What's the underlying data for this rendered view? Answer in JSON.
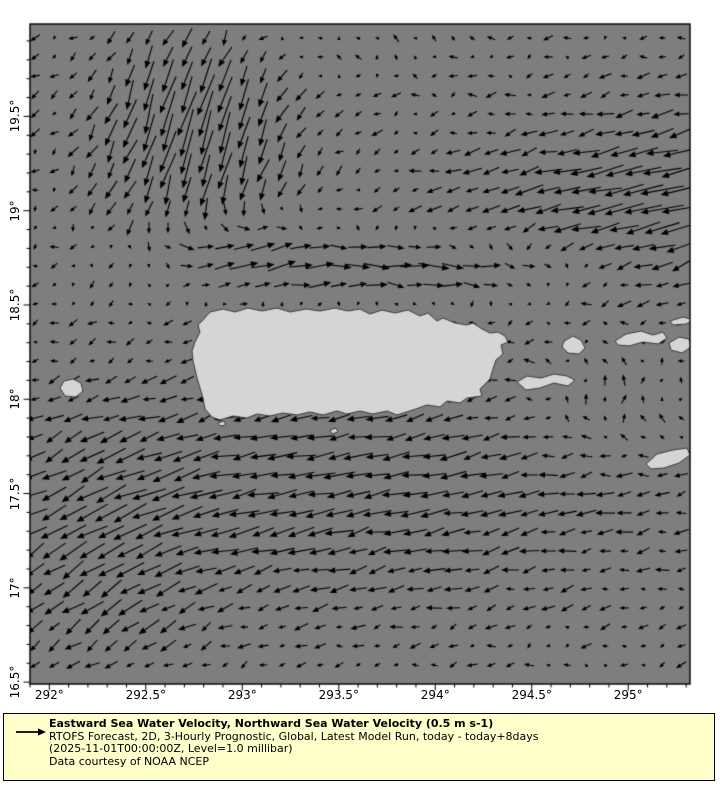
{
  "figure": {
    "width": 720,
    "height": 800,
    "background": "#ffffff"
  },
  "map": {
    "ocean_color": "#7e7e7e",
    "land_fill": "#d5d5d5",
    "land_edge": "#3d3d3d",
    "arrow_color": "#000000",
    "frame_color": "#000000",
    "lon_min": 291.9,
    "lon_max": 295.32,
    "lat_min": 16.49,
    "lat_max": 19.99,
    "x_major_ticks": [
      {
        "lon": 292.0,
        "label": "292°"
      },
      {
        "lon": 292.5,
        "label": "292.5°"
      },
      {
        "lon": 293.0,
        "label": "293°"
      },
      {
        "lon": 293.5,
        "label": "293.5°"
      },
      {
        "lon": 294.0,
        "label": "294°"
      },
      {
        "lon": 294.5,
        "label": "294.5°"
      },
      {
        "lon": 295.0,
        "label": "295°"
      }
    ],
    "y_major_ticks": [
      {
        "lat": 19.5,
        "label": "19.5°"
      },
      {
        "lat": 19.0,
        "label": "19°"
      },
      {
        "lat": 18.5,
        "label": "18.5°"
      },
      {
        "lat": 18.0,
        "label": "18°"
      },
      {
        "lat": 17.5,
        "label": "17.5°"
      },
      {
        "lat": 17.0,
        "label": "17°"
      },
      {
        "lat": 16.5,
        "label": "16.5°"
      }
    ],
    "minor_tick_step_deg": 0.1,
    "grid_step_px": 19,
    "reference_speed_ms": 0.5,
    "reference_arrow_px": 19,
    "jitter": 0.24
  },
  "chart_data": {
    "type": "quiver-vector-map",
    "title": "Eastward Sea Water Velocity, Northward Sea Water Velocity (0.5 m s-1)",
    "x_axis": {
      "label": "longitude",
      "range": [
        291.9,
        295.32
      ],
      "ticks": [
        "292°",
        "292.5°",
        "293°",
        "293.5°",
        "294°",
        "294.5°",
        "295°"
      ]
    },
    "y_axis": {
      "label": "latitude",
      "range": [
        16.49,
        19.99
      ],
      "ticks": [
        "16.5°",
        "17°",
        "17.5°",
        "18°",
        "18.5°",
        "19°",
        "19.5°"
      ]
    },
    "reference_vector": "0.5 m s-1",
    "region": "Puerto Rico and Virgin Islands"
  },
  "flow_features": [
    {
      "name": "nw-southward-jet",
      "type": "gaussian",
      "u": -0.25,
      "v": -1.15,
      "lon0": 292.75,
      "sx": 0.5,
      "lat0": 19.45,
      "sy": 0.58
    },
    {
      "name": "north-westward-jet",
      "type": "gaussian",
      "u": -1.05,
      "v": -0.22,
      "lon0": 295.45,
      "sx": 1.15,
      "lat0": 19.05,
      "sy": 0.45
    },
    {
      "name": "north-coast-eastward-jet",
      "type": "gaussian",
      "u": 1.0,
      "v": 0.04,
      "lon0": 293.9,
      "sx": 0.95,
      "lat0": 18.7,
      "sy": 0.17
    },
    {
      "name": "northeast-inflow",
      "type": "gaussian",
      "u": 0.5,
      "v": 0.45,
      "lon0": 292.95,
      "sx": 0.4,
      "lat0": 18.78,
      "sy": 0.28
    },
    {
      "name": "south-westward-flow",
      "type": "gaussian",
      "u": -0.62,
      "v": -0.1,
      "lon0": 293.4,
      "sx": 1.7,
      "lat0": 17.5,
      "sy": 0.6
    },
    {
      "name": "southwest-diagonal",
      "type": "gaussian",
      "u": -0.3,
      "v": -0.33,
      "lon0": 292.25,
      "sx": 0.55,
      "lat0": 17.15,
      "sy": 0.7
    },
    {
      "name": "virgin-islands-ne-flow",
      "type": "gaussian",
      "u": 0.28,
      "v": 0.3,
      "lon0": 294.95,
      "sx": 0.45,
      "lat0": 18.0,
      "sy": 0.3
    },
    {
      "name": "top-northward-drift",
      "type": "gaussian",
      "u": 0.05,
      "v": 0.28,
      "lon0": 293.2,
      "sx": 0.9,
      "lat0": 19.95,
      "sy": 0.3
    },
    {
      "name": "base-drift",
      "type": "uniform",
      "u": -0.13,
      "v": -0.05
    }
  ],
  "islands": {
    "puerto_rico": [
      [
        180,
        288
      ],
      [
        193,
        285
      ],
      [
        205,
        288
      ],
      [
        218,
        284
      ],
      [
        232,
        287
      ],
      [
        247,
        284
      ],
      [
        260,
        288
      ],
      [
        276,
        285
      ],
      [
        290,
        287
      ],
      [
        305,
        284
      ],
      [
        318,
        287
      ],
      [
        330,
        285
      ],
      [
        340,
        290
      ],
      [
        352,
        286
      ],
      [
        365,
        289
      ],
      [
        378,
        286
      ],
      [
        390,
        292
      ],
      [
        398,
        289
      ],
      [
        407,
        297
      ],
      [
        413,
        294
      ],
      [
        425,
        299
      ],
      [
        437,
        301
      ],
      [
        443,
        299
      ],
      [
        452,
        305
      ],
      [
        460,
        309
      ],
      [
        468,
        308
      ],
      [
        475,
        312
      ],
      [
        478,
        318
      ],
      [
        471,
        321
      ],
      [
        473,
        330
      ],
      [
        466,
        336
      ],
      [
        463,
        345
      ],
      [
        460,
        355
      ],
      [
        450,
        365
      ],
      [
        452,
        372
      ],
      [
        437,
        374
      ],
      [
        430,
        379
      ],
      [
        417,
        377
      ],
      [
        410,
        383
      ],
      [
        397,
        381
      ],
      [
        383,
        386
      ],
      [
        367,
        391
      ],
      [
        357,
        387
      ],
      [
        343,
        390
      ],
      [
        330,
        387
      ],
      [
        317,
        390
      ],
      [
        307,
        387
      ],
      [
        293,
        391
      ],
      [
        280,
        388
      ],
      [
        267,
        391
      ],
      [
        253,
        389
      ],
      [
        240,
        392
      ],
      [
        227,
        390
      ],
      [
        217,
        394
      ],
      [
        203,
        392
      ],
      [
        190,
        396
      ],
      [
        182,
        393
      ],
      [
        175,
        385
      ],
      [
        173,
        374
      ],
      [
        170,
        364
      ],
      [
        167,
        354
      ],
      [
        163,
        337
      ],
      [
        162,
        327
      ],
      [
        165,
        318
      ],
      [
        170,
        308
      ],
      [
        168,
        301
      ],
      [
        173,
        296
      ]
    ],
    "mona": [
      [
        30,
        364
      ],
      [
        34,
        357
      ],
      [
        43,
        355
      ],
      [
        51,
        359
      ],
      [
        53,
        367
      ],
      [
        46,
        373
      ],
      [
        35,
        372
      ]
    ],
    "vieques": [
      [
        487,
        358
      ],
      [
        497,
        352
      ],
      [
        511,
        354
      ],
      [
        524,
        350
      ],
      [
        537,
        352
      ],
      [
        545,
        356
      ],
      [
        538,
        362
      ],
      [
        524,
        359
      ],
      [
        510,
        364
      ],
      [
        496,
        366
      ]
    ],
    "culebra": [
      [
        534,
        317
      ],
      [
        543,
        312
      ],
      [
        551,
        316
      ],
      [
        555,
        324
      ],
      [
        549,
        330
      ],
      [
        538,
        329
      ],
      [
        532,
        323
      ]
    ],
    "st_thomas": [
      [
        585,
        317
      ],
      [
        596,
        310
      ],
      [
        611,
        307
      ],
      [
        623,
        311
      ],
      [
        633,
        308
      ],
      [
        637,
        314
      ],
      [
        628,
        320
      ],
      [
        613,
        318
      ],
      [
        599,
        322
      ],
      [
        588,
        321
      ]
    ],
    "st_john": [
      [
        639,
        319
      ],
      [
        649,
        313
      ],
      [
        659,
        315
      ],
      [
        661,
        323
      ],
      [
        652,
        329
      ],
      [
        641,
        326
      ]
    ],
    "tortola_sliver": [
      [
        640,
        297
      ],
      [
        653,
        293
      ],
      [
        664,
        296
      ],
      [
        656,
        300
      ],
      [
        643,
        301
      ]
    ],
    "st_croix": [
      [
        616,
        440
      ],
      [
        627,
        430
      ],
      [
        643,
        426
      ],
      [
        657,
        424
      ],
      [
        660,
        431
      ],
      [
        649,
        439
      ],
      [
        634,
        444
      ],
      [
        621,
        445
      ]
    ],
    "caja_de_muertos": [
      [
        300,
        406
      ],
      [
        306,
        404
      ],
      [
        308,
        408
      ],
      [
        302,
        410
      ]
    ],
    "small_cay": [
      [
        188,
        399
      ],
      [
        194,
        397
      ],
      [
        196,
        401
      ],
      [
        190,
        402
      ]
    ]
  },
  "legend": {
    "background": "#ffffcc",
    "border_color": "#000000",
    "title": "Eastward Sea Water Velocity, Northward Sea Water Velocity (0.5 m s-1)",
    "line2": "RTOFS Forecast, 2D, 3-Hourly Prognostic, Global, Latest Model Run, today - today+8days",
    "line3": "(2025-11-01T00:00:00Z, Level=1.0 millibar)",
    "line4": "Data courtesy of NOAA NCEP"
  }
}
